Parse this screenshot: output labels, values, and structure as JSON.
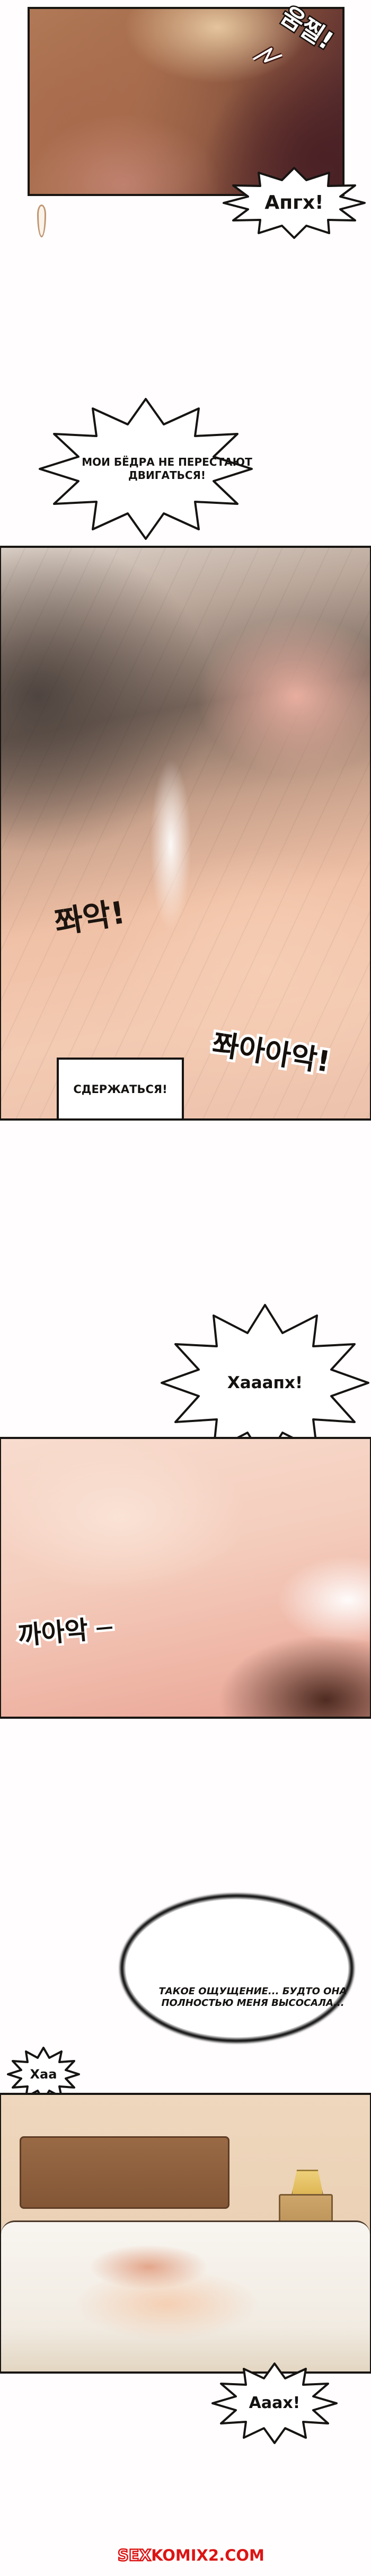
{
  "watermark": {
    "prefix": "SEX",
    "suffix": "KOMIX2.COM",
    "color": "#dd1414"
  },
  "dialogue": {
    "gasp1": "Апгх!",
    "hips_line1": "МОИ БЁДРА НЕ ПЕРЕСТАЮТ",
    "hips_line2": "ДВИГАТЬСЯ!",
    "restrain": "СДЕРЖАТЬСЯ!",
    "gasp2": "Хааапх!",
    "thought_line1": "ТАКОЕ ОЩУЩЕНИЕ... БУДТО ОНА",
    "thought_line2": "ПОЛНОСТЬЮ МЕНЯ ВЫСОСАЛА...",
    "breath": "Хаа",
    "gasp3": "Ааах!"
  },
  "sfx": {
    "flinch": "움찔!",
    "slap": "쫘악!",
    "slap_long": "쫘아아악!",
    "squeeze": "까아악 ─"
  }
}
